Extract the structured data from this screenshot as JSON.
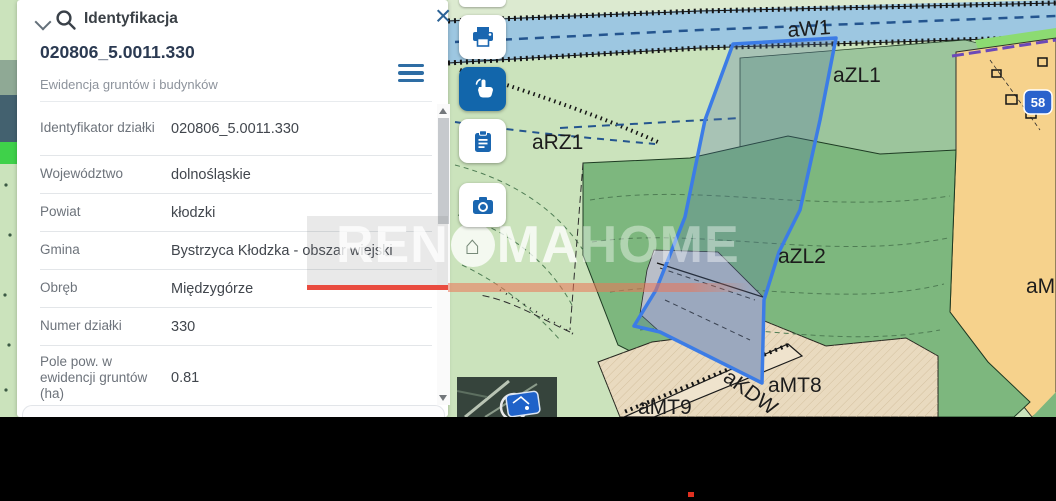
{
  "panel": {
    "title": "Identyfikacja",
    "result": {
      "id": "020806_5.0011.330",
      "source": "Ewidencja gruntów i budynków"
    },
    "fields": [
      {
        "label": "Identyfikator działki",
        "value": "020806_5.0011.330"
      },
      {
        "label": "Województwo",
        "value": "dolnośląskie"
      },
      {
        "label": "Powiat",
        "value": "kłodzki"
      },
      {
        "label": "Gmina",
        "value": "Bystrzyca Kłodzka - obszar wiejski"
      },
      {
        "label": "Obręb",
        "value": "Międzygórze"
      },
      {
        "label": "Numer działki",
        "value": "330"
      },
      {
        "label": "Pole pow. w ewidencji gruntów (ha)",
        "value": "0.81"
      }
    ]
  },
  "icons": {
    "close_glyph": "×"
  },
  "toolbar": {
    "buttons": [
      {
        "name": "print"
      },
      {
        "name": "identify",
        "active": true
      },
      {
        "name": "copy-results"
      },
      {
        "name": "screenshot"
      }
    ]
  },
  "map": {
    "zone_labels": [
      {
        "text": "aW1"
      },
      {
        "text": "aZL1"
      },
      {
        "text": "aRZ1"
      },
      {
        "text": "aZL2"
      },
      {
        "text": "aMT8"
      },
      {
        "text": "aMT9"
      },
      {
        "text": "aKDW"
      },
      {
        "text": "aMR"
      }
    ],
    "road_shield": "58",
    "selected_parcel": "330"
  },
  "watermark": {
    "solid_prefix": "REN",
    "solid_suffix": "MA",
    "outline": "HOME",
    "house_glyph": "⌂",
    "accent_color": "#e94b3f"
  },
  "colors": {
    "accent_blue": "#1266ab",
    "parcel_outline": "#3c7ce6",
    "forest_green": "#7db77e",
    "meadow_green": "#cbe3bc",
    "water_blue": "#9dc7e1",
    "zone_orange": "#f6d28c"
  }
}
